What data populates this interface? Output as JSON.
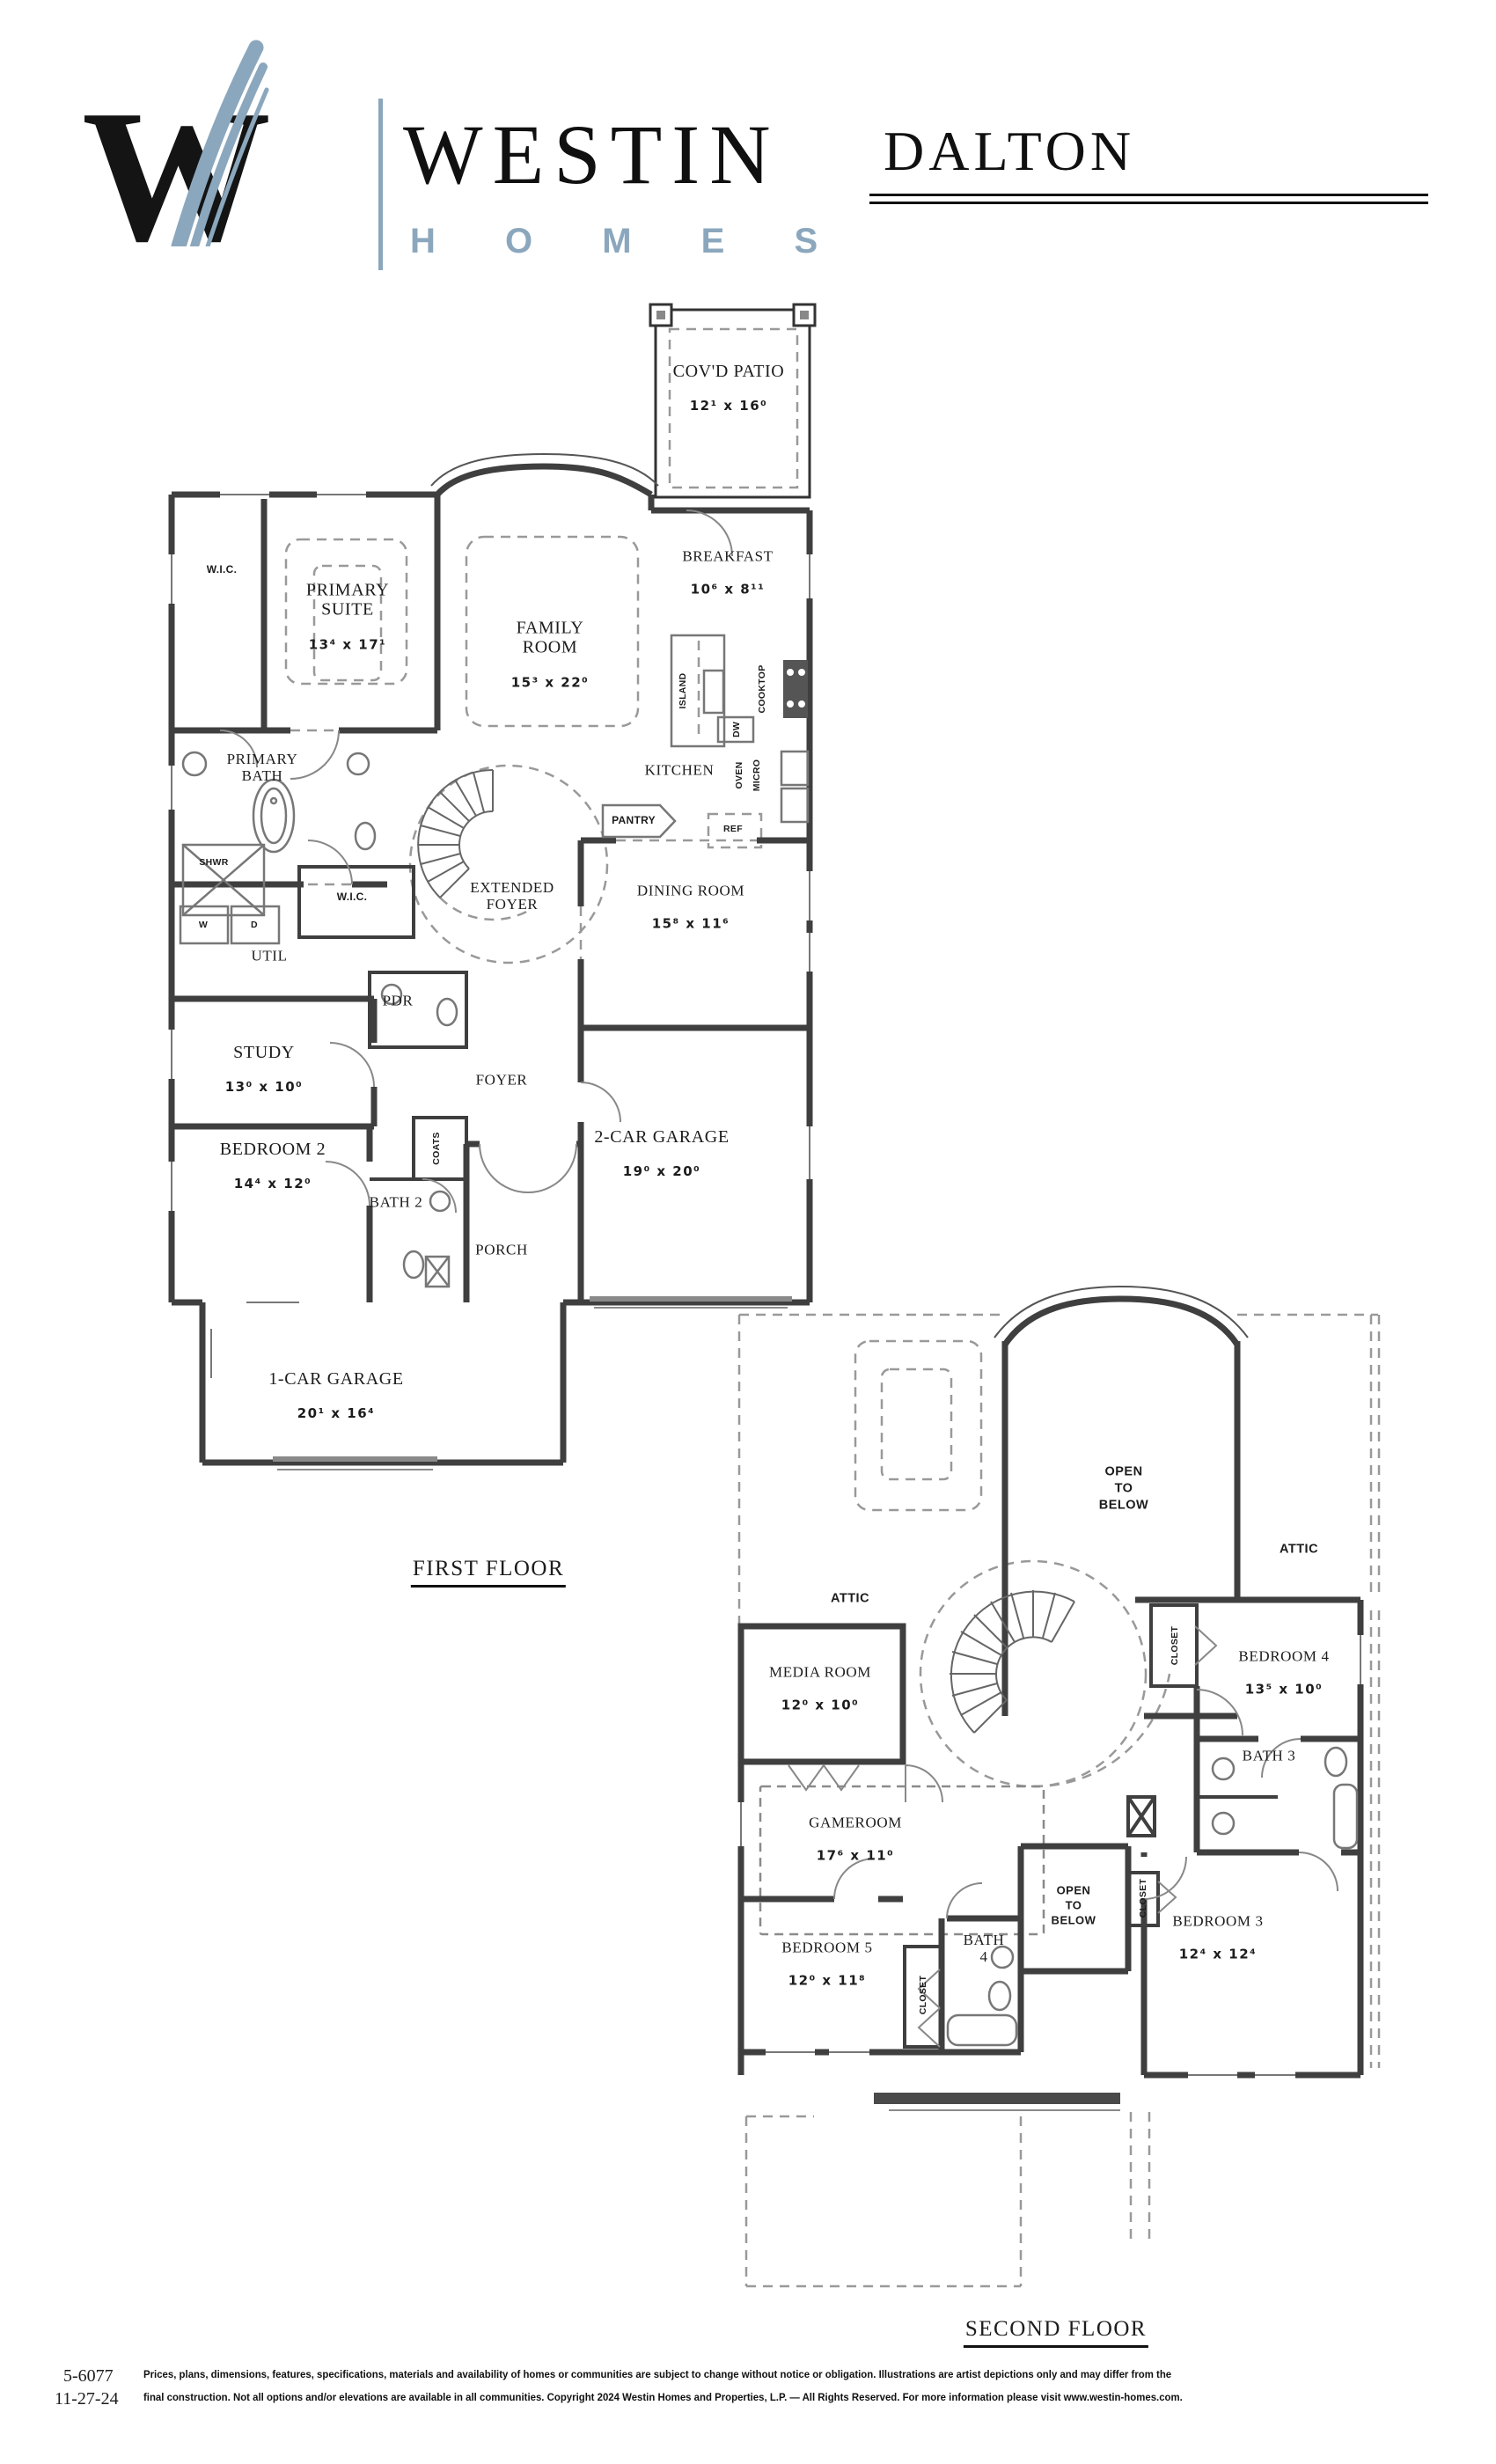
{
  "header": {
    "monogram": "W",
    "brand": "WESTIN",
    "brand_sub": "H O M E S",
    "plan_name": "DALTON",
    "accent_color": "#8ba7bd"
  },
  "first_floor": {
    "title": "FIRST FLOOR",
    "rooms": {
      "covd_patio": {
        "name": "COV'D PATIO",
        "dim": "12¹ x 16⁰"
      },
      "wic1": {
        "name": "W.I.C."
      },
      "primary_suite": {
        "name": "PRIMARY\nSUITE",
        "dim": "13⁴ x 17¹"
      },
      "family_room": {
        "name": "FAMILY\nROOM",
        "dim": "15³ x 22⁰"
      },
      "breakfast": {
        "name": "BREAKFAST",
        "dim": "10⁶ x 8¹¹"
      },
      "kitchen": {
        "name": "KITCHEN"
      },
      "island": {
        "name": "ISLAND"
      },
      "dw": {
        "name": "DW"
      },
      "cooktop": {
        "name": "COOKTOP"
      },
      "oven": {
        "name": "OVEN"
      },
      "micro": {
        "name": "MICRO"
      },
      "ref": {
        "name": "REF"
      },
      "pantry": {
        "name": "PANTRY"
      },
      "primary_bath": {
        "name": "PRIMARY\nBATH"
      },
      "shwr": {
        "name": "SHWR"
      },
      "washer": {
        "name": "W"
      },
      "dryer": {
        "name": "D"
      },
      "util": {
        "name": "UTIL"
      },
      "wic2": {
        "name": "W.I.C."
      },
      "extended_foyer": {
        "name": "EXTENDED\nFOYER"
      },
      "dining": {
        "name": "DINING ROOM",
        "dim": "15⁸ x 11⁶"
      },
      "pdr": {
        "name": "PDR"
      },
      "study": {
        "name": "STUDY",
        "dim": "13⁰ x 10⁰"
      },
      "foyer": {
        "name": "FOYER"
      },
      "bedroom2": {
        "name": "BEDROOM 2",
        "dim": "14⁴ x 12⁰"
      },
      "coats": {
        "name": "COATS"
      },
      "bath2": {
        "name": "BATH 2"
      },
      "porch": {
        "name": "PORCH"
      },
      "garage2": {
        "name": "2-CAR GARAGE",
        "dim": "19⁰ x 20⁰"
      },
      "garage1": {
        "name": "1-CAR GARAGE",
        "dim": "20¹ x 16⁴"
      }
    }
  },
  "second_floor": {
    "title": "SECOND FLOOR",
    "rooms": {
      "attic_left": {
        "name": "ATTIC"
      },
      "attic_right": {
        "name": "ATTIC"
      },
      "media": {
        "name": "MEDIA ROOM",
        "dim": "12⁰ x 10⁰"
      },
      "open_below_top": {
        "name": "OPEN\nTO\nBELOW"
      },
      "closet_b4": {
        "name": "CLOSET"
      },
      "bedroom4": {
        "name": "BEDROOM 4",
        "dim": "13⁵ x 10⁰"
      },
      "bath3": {
        "name": "BATH 3"
      },
      "gameroom": {
        "name": "GAMEROOM",
        "dim": "17⁶ x 11⁰"
      },
      "open_below_bottom": {
        "name": "OPEN\nTO\nBELOW"
      },
      "closet_b3": {
        "name": "CLOSET"
      },
      "bedroom3": {
        "name": "BEDROOM 3",
        "dim": "12⁴ x 12⁴"
      },
      "bedroom5": {
        "name": "BEDROOM 5",
        "dim": "12⁰ x 11⁸"
      },
      "closet_b5": {
        "name": "CLOSET"
      },
      "bath4": {
        "name": "BATH\n4"
      }
    }
  },
  "footer": {
    "plan_number": "5-6077",
    "date": "11-27-24",
    "disclaimer_line1": "Prices, plans, dimensions, features, specifications, materials and availability of homes or communities are subject to change without notice or obligation.  Illustrations are artist depictions only and may differ from the",
    "disclaimer_line2": "final construction.  Not all options and/or elevations are available in all communities.  Copyright 2024 Westin Homes and Properties, L.P. — All Rights Reserved.  For more information please visit www.westin-homes.com."
  }
}
